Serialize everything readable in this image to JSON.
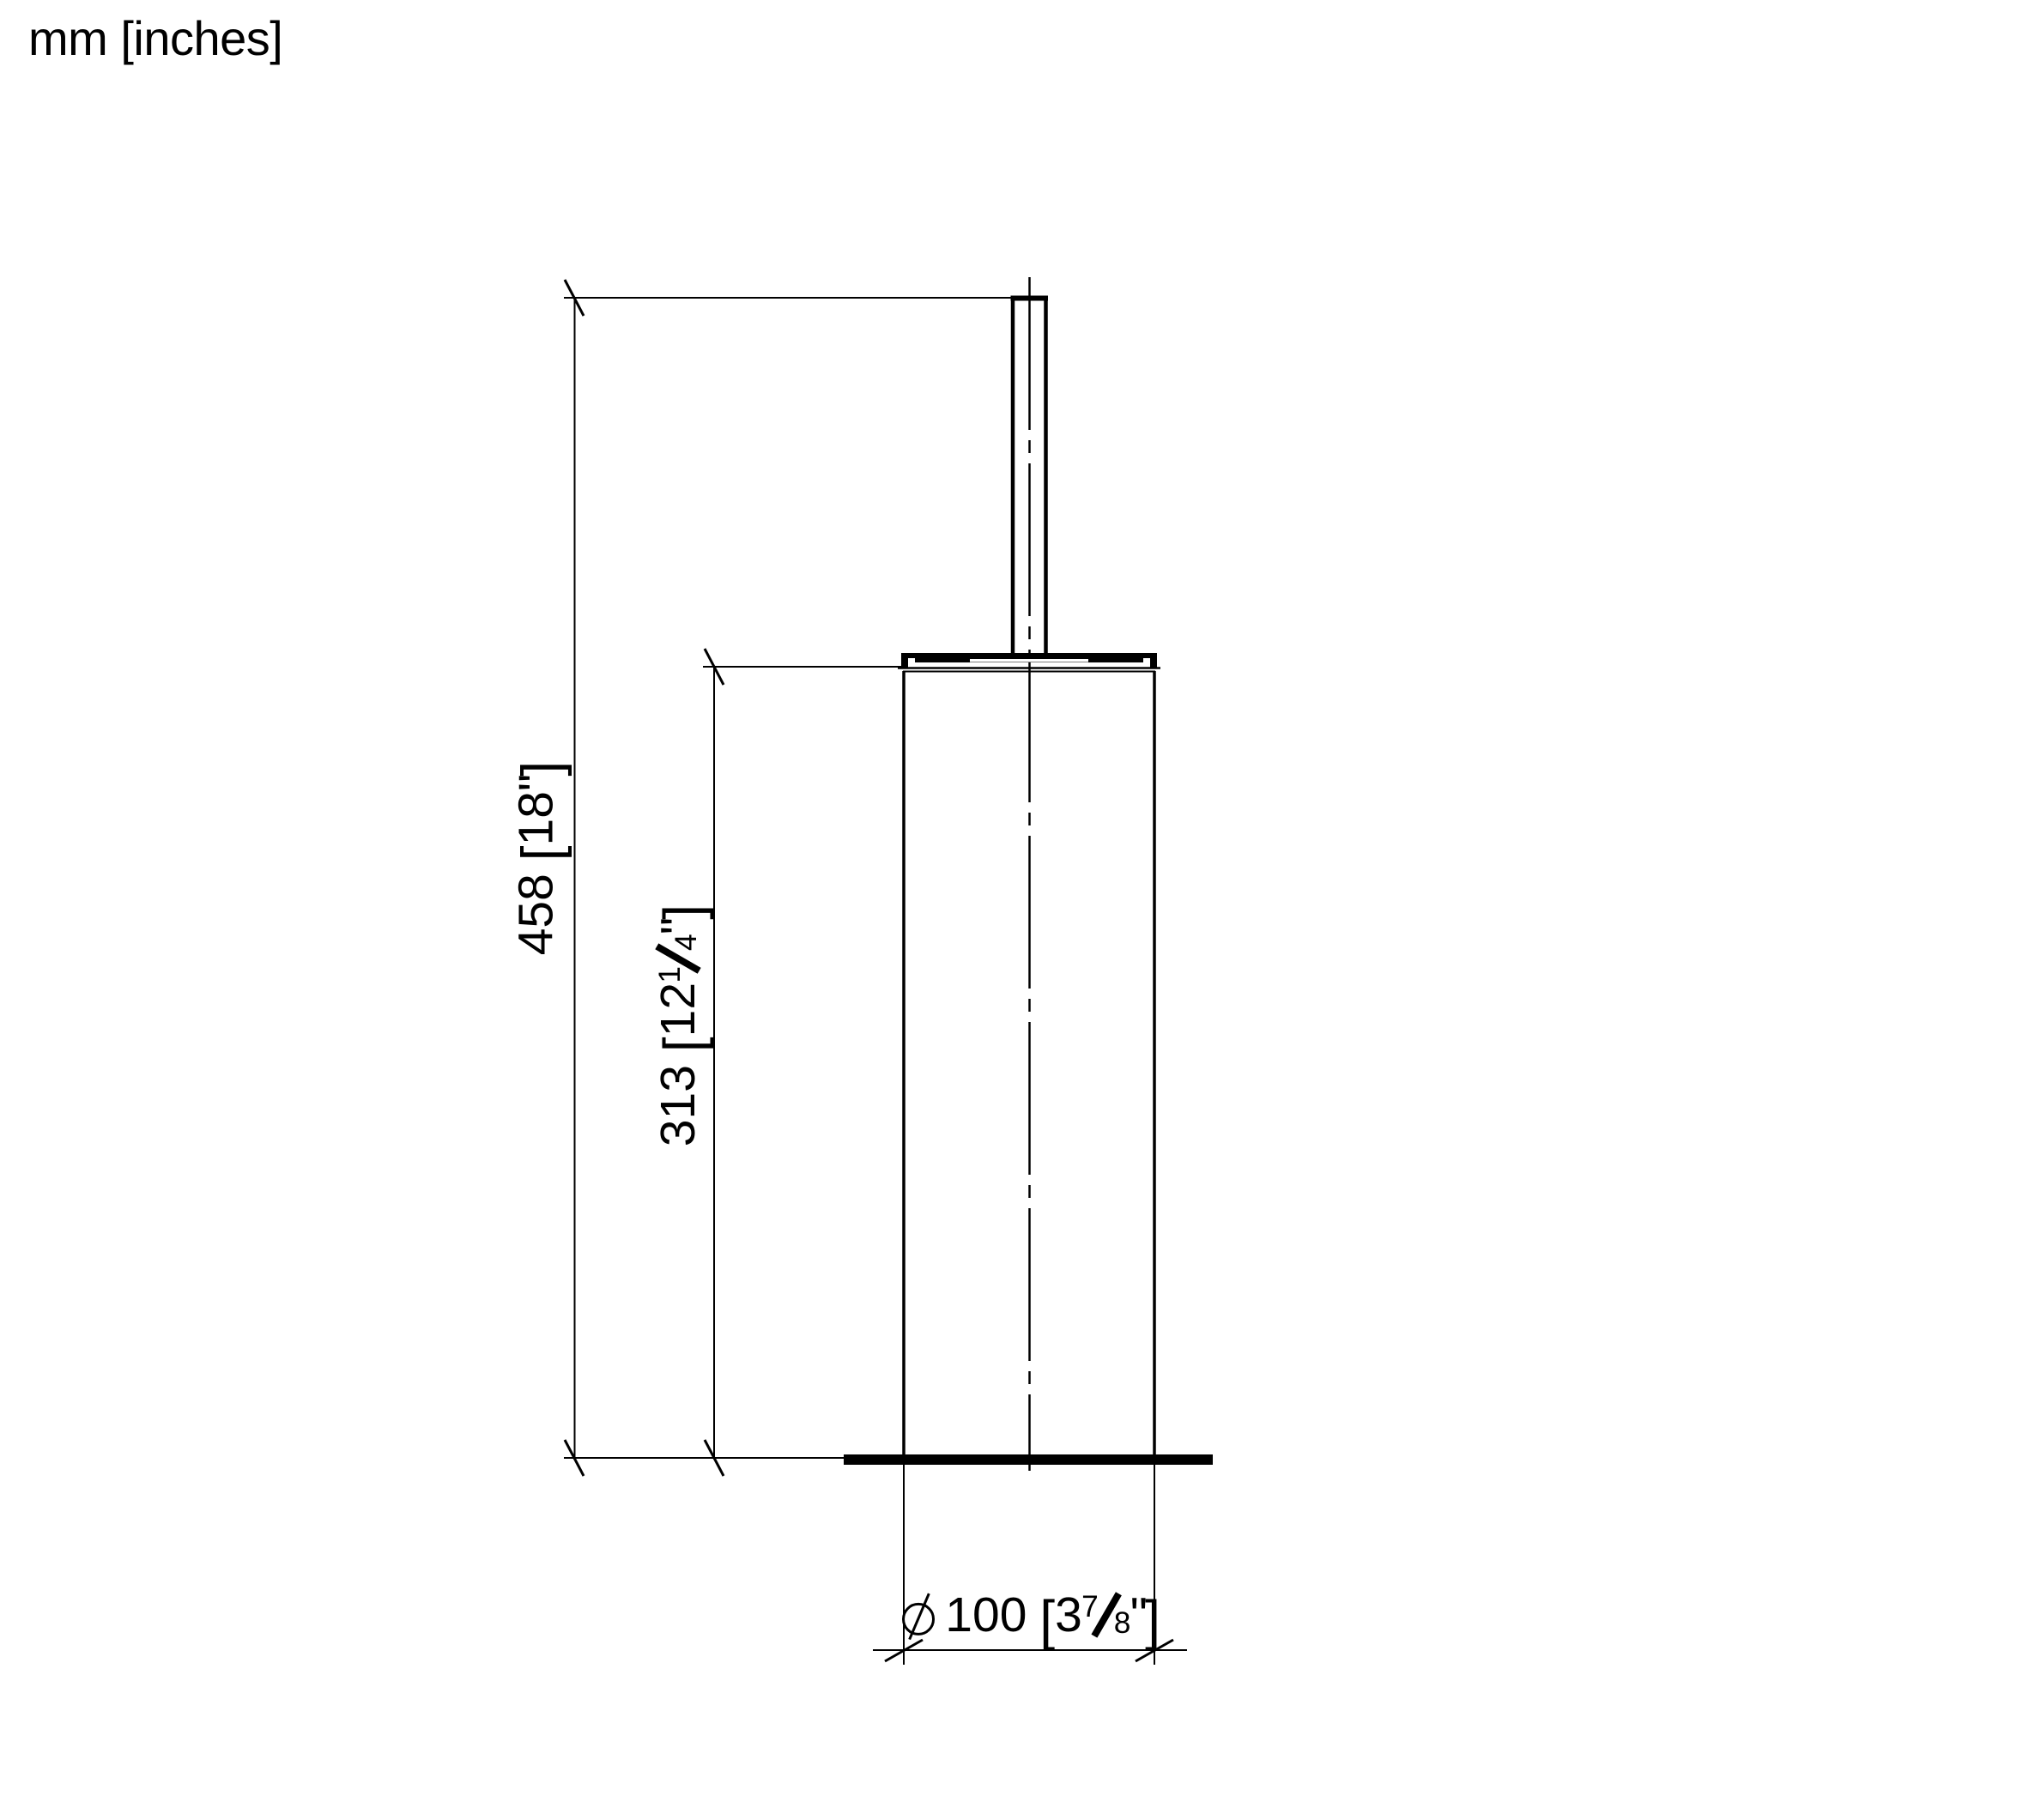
{
  "page": {
    "background": "#ffffff",
    "ink": "#000000"
  },
  "units_note": "mm [inches]",
  "drawing": {
    "kind": "technical elevation drawing",
    "subject": "floor-standing cylindrical container with vertical handle (brush holder)"
  },
  "dimensions": {
    "overall_height": {
      "plain": "458 [18\"]",
      "mm": "458",
      "bracket_open": "[",
      "inches": "18",
      "inch_mark": "\"",
      "bracket_close": "]"
    },
    "container_height": {
      "plain": "313 [12 1/4\"]",
      "mm": "313",
      "bracket_open": "[",
      "inches_whole": "12",
      "frac_numerator": "1",
      "frac_denominator": "4",
      "inch_mark": "\"",
      "bracket_close": "]"
    },
    "diameter": {
      "plain": "Ø100 [3 7/8\"]",
      "symbol": "Ø",
      "mm": "100",
      "bracket_open": "[",
      "inches_whole": "3",
      "frac_numerator": "7",
      "frac_denominator": "8",
      "inch_mark": "\"",
      "bracket_close": "]"
    }
  }
}
